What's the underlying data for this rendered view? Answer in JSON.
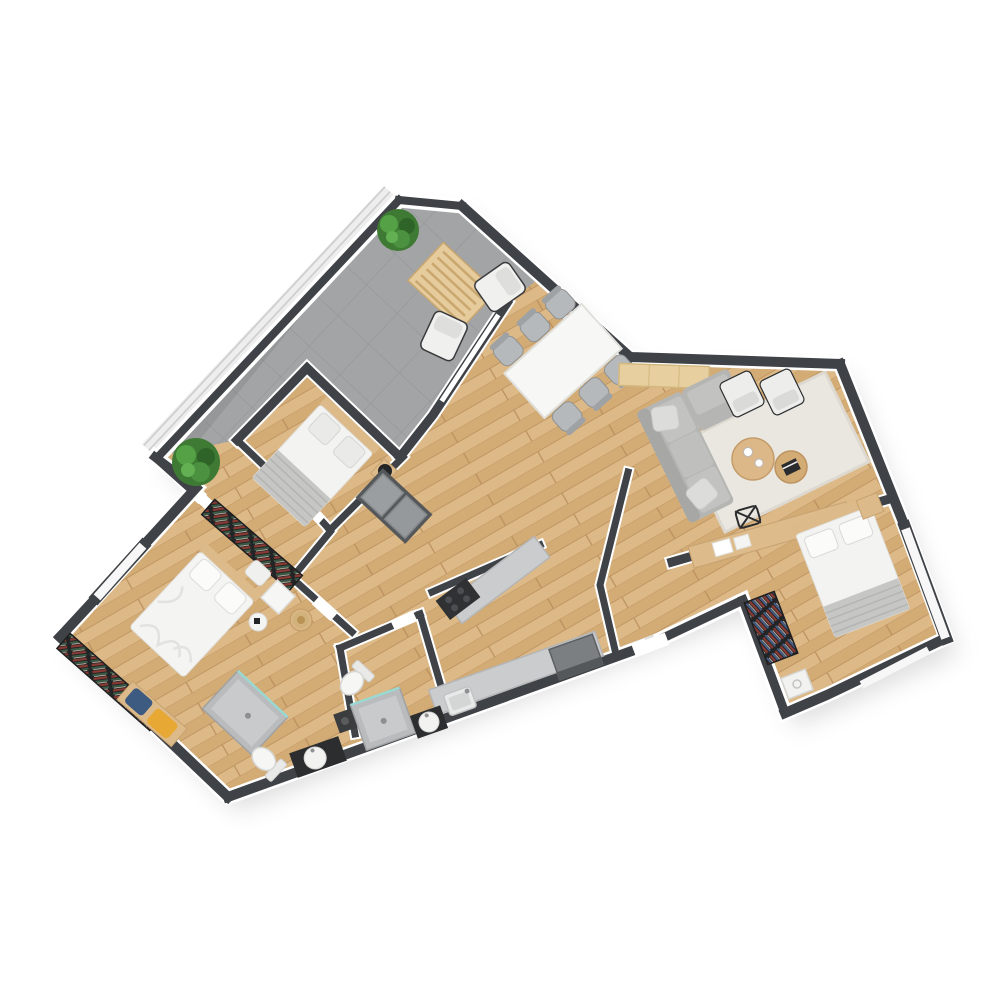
{
  "title": "apartment-floor-plan-top-view",
  "canvas": {
    "width": 1000,
    "height": 1000,
    "background": "#ffffff"
  },
  "palette": {
    "wall": "#3f4246",
    "wall_trim": "#ffffff",
    "wood_floor": "#d8b27c",
    "terrace_tile": "#a3a4a5",
    "counter_gray": "#cbcccd",
    "shower_gray": "#b9bbbd",
    "sofa_gray": "#b5b6b4",
    "rug_cream": "#eae7e0",
    "furniture_wood": "#dcba8a",
    "appliance_dark": "#3a3c3e",
    "bedding_white": "#f3f3f1",
    "blanket_gray": "#c6c7c5",
    "plant_green": "#4c9140",
    "cushion_blue": "#3d5a80",
    "cushion_yellow": "#e8a834",
    "bookshelf_dark": "#232426"
  },
  "rooms": [
    {
      "name": "terrace",
      "floor": "gray-tile",
      "furniture": [
        "potted-plant-top",
        "potted-plant-left",
        "slatted-wood-table",
        "lounge-chair-1",
        "lounge-chair-2"
      ]
    },
    {
      "name": "living-dining-area",
      "floor": "wood",
      "furniture": [
        "dining-table",
        "dining-chairs(6)",
        "sideboard",
        "corner-sofa",
        "sofa-pillows(2)",
        "area-rug",
        "round-coffee-table-large",
        "round-coffee-table-small",
        "coffee-cups(2)",
        "black-book",
        "armchair-1",
        "armchair-2"
      ]
    },
    {
      "name": "bedroom-small",
      "floor": "wood",
      "furniture": [
        "double-bed",
        "pillows(2)",
        "gray-blanket",
        "nightstand",
        "black-table-lamp",
        "built-in-wardrobe"
      ]
    },
    {
      "name": "bedroom-master",
      "floor": "wood",
      "furniture": [
        "double-bed",
        "bookshelf-north",
        "bookshelf-south",
        "white-nightstand",
        "shelf-pillow",
        "bench",
        "blue-cushion",
        "yellow-cushion",
        "stool-with-straw-hat",
        "decor-tray"
      ]
    },
    {
      "name": "bedroom-second",
      "floor": "wood",
      "furniture": [
        "double-bed",
        "pillows(2)",
        "headboard",
        "nightstand",
        "long-desk",
        "desk-papers",
        "wire-chair"
      ]
    },
    {
      "name": "walk-in-closet",
      "floor": "wood",
      "furniture": [
        "bookshelf",
        "white-appliance"
      ]
    },
    {
      "name": "kitchen",
      "floor": "wood",
      "furniture": [
        "counter-lower",
        "sink",
        "refrigerator",
        "counter-upper",
        "cooktop"
      ]
    },
    {
      "name": "bathroom-hall",
      "floor": "wood",
      "furniture": [
        "shower",
        "toilet",
        "vanity-with-round-basin",
        "washing-machine"
      ]
    },
    {
      "name": "bathroom-ensuite",
      "floor": "wood",
      "furniture": [
        "shower",
        "toilet",
        "vanity-with-round-basin"
      ]
    },
    {
      "name": "hallway-entry",
      "floor": "wood",
      "furniture": [
        "entry-door-opening"
      ]
    }
  ],
  "counts": {
    "bedrooms": 3,
    "bathrooms": 2,
    "plants": 2,
    "dining_chairs": 6,
    "armchairs": 2,
    "lounge_chairs": 2
  },
  "windows": [
    "master-northwest-window",
    "bedroom-second-east-window",
    "bedroom-second-southeast-window",
    "terrace-glass-slider",
    "living-glass-slider"
  ]
}
